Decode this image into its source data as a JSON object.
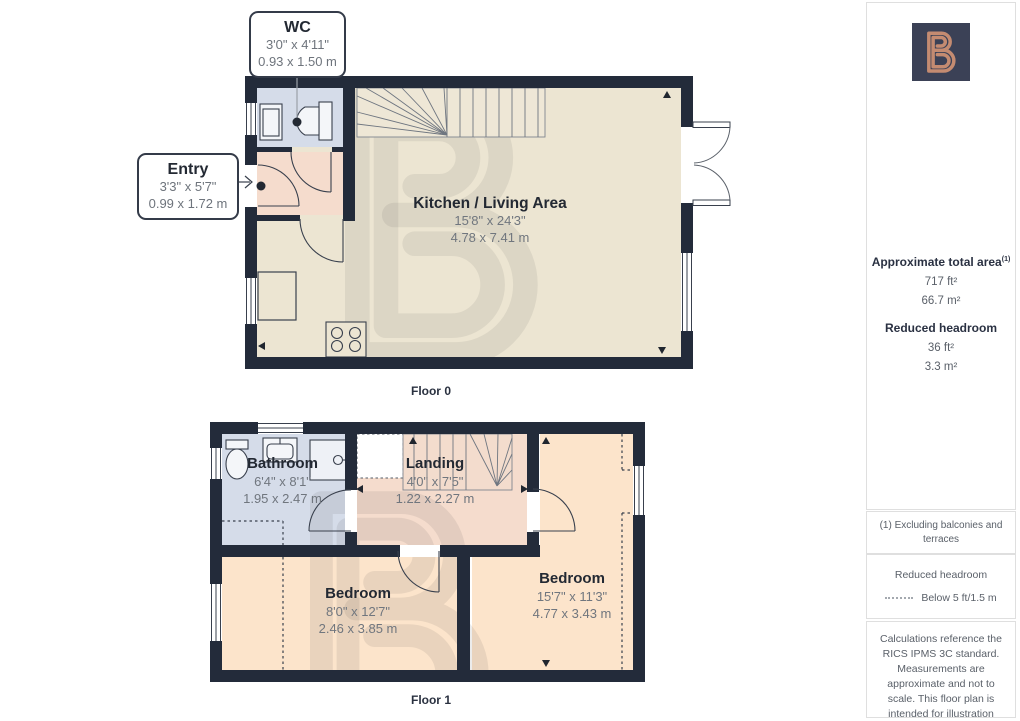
{
  "branding": {
    "logo_glyph": "B",
    "logo_bg": "#3b4156",
    "logo_fg": "#c48b71"
  },
  "colors": {
    "wall": "#232b3a",
    "kitchen_floor": "#ece5d2",
    "bathroom_floor": "#d5dce9",
    "hall_floor": "#f5dccd",
    "bedroom_floor": "#fce4cb"
  },
  "floor0": {
    "label": "Floor 0",
    "wc": {
      "title": "WC",
      "imperial": "3'0\" x 4'11\"",
      "metric": "0.93 x 1.50 m"
    },
    "entry": {
      "title": "Entry",
      "imperial": "3'3\" x 5'7\"",
      "metric": "0.99 x 1.72 m"
    },
    "kitchen": {
      "title": "Kitchen / Living Area",
      "imperial": "15'8\" x 24'3\"",
      "metric": "4.78 x 7.41 m"
    }
  },
  "floor1": {
    "label": "Floor 1",
    "bathroom": {
      "title": "Bathroom",
      "imperial": "6'4\" x 8'1\"",
      "metric": "1.95 x 2.47 m"
    },
    "landing": {
      "title": "Landing",
      "imperial": "4'0\" x 7'5\"",
      "metric": "1.22 x 2.27 m"
    },
    "bedroom_left": {
      "title": "Bedroom",
      "imperial": "8'0\" x 12'7\"",
      "metric": "2.46 x 3.85 m"
    },
    "bedroom_right": {
      "title": "Bedroom",
      "imperial": "15'7\" x 11'3\"",
      "metric": "4.77 x 3.43 m"
    }
  },
  "sidebar": {
    "total_area_heading": "Approximate total area",
    "total_area_sup": "(1)",
    "total_area_imperial": "717 ft²",
    "total_area_metric": "66.7 m²",
    "headroom_heading": "Reduced headroom",
    "headroom_imperial": "36 ft²",
    "headroom_metric": "3.3 m²",
    "footnote": "(1) Excluding balconies and terraces",
    "legend_heading": "Reduced headroom",
    "legend_item": "Below 5 ft/1.5 m",
    "disclaimer": "Calculations reference the RICS IPMS 3C standard. Measurements are approximate and not to scale. This floor plan is intended for illustration only."
  }
}
